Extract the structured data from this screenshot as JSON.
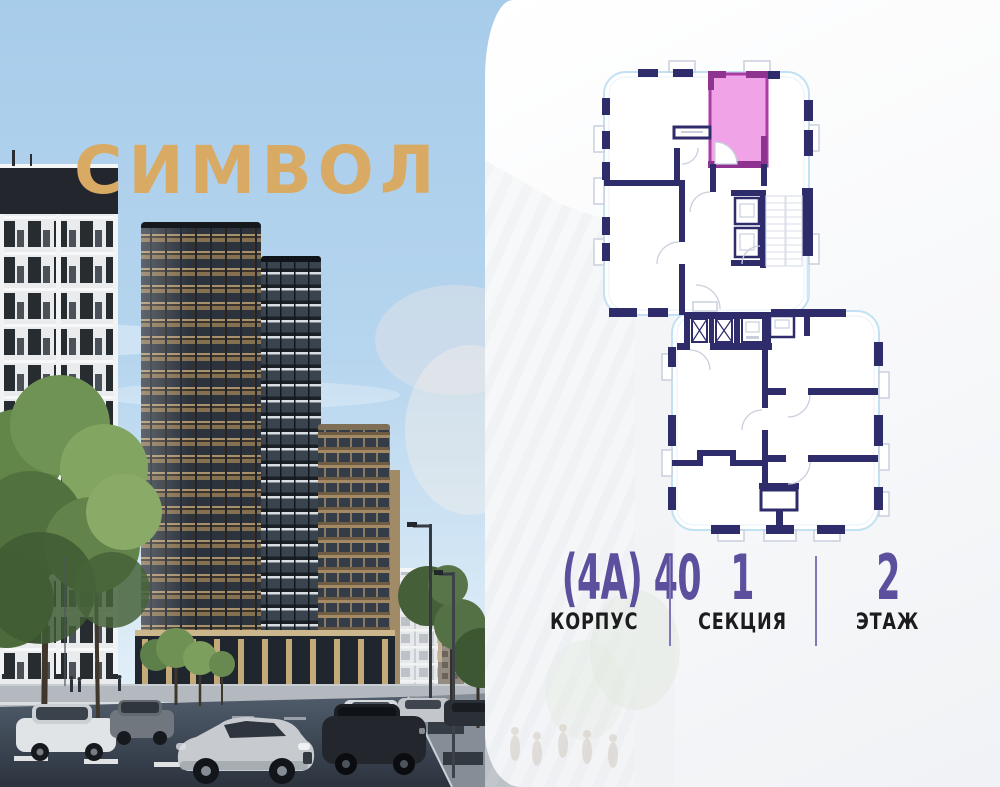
{
  "brand": {
    "name": "СИМВОЛ",
    "logo_color": "#d9aa64"
  },
  "floor_plan": {
    "wall_color": "#2e2c6a",
    "outline_color": "#c2e2f4",
    "selected_unit": {
      "fill": "#f0a3e6",
      "border": "#ab3ba5"
    }
  },
  "info": {
    "accent_color": "#5b4f9e",
    "divider_color": "#8276b8",
    "items": [
      {
        "value": "(4А) 40",
        "label": "КОРПУС"
      },
      {
        "value": "1",
        "label": "СЕКЦИЯ"
      },
      {
        "value": "2",
        "label": "ЭТАЖ"
      }
    ]
  }
}
